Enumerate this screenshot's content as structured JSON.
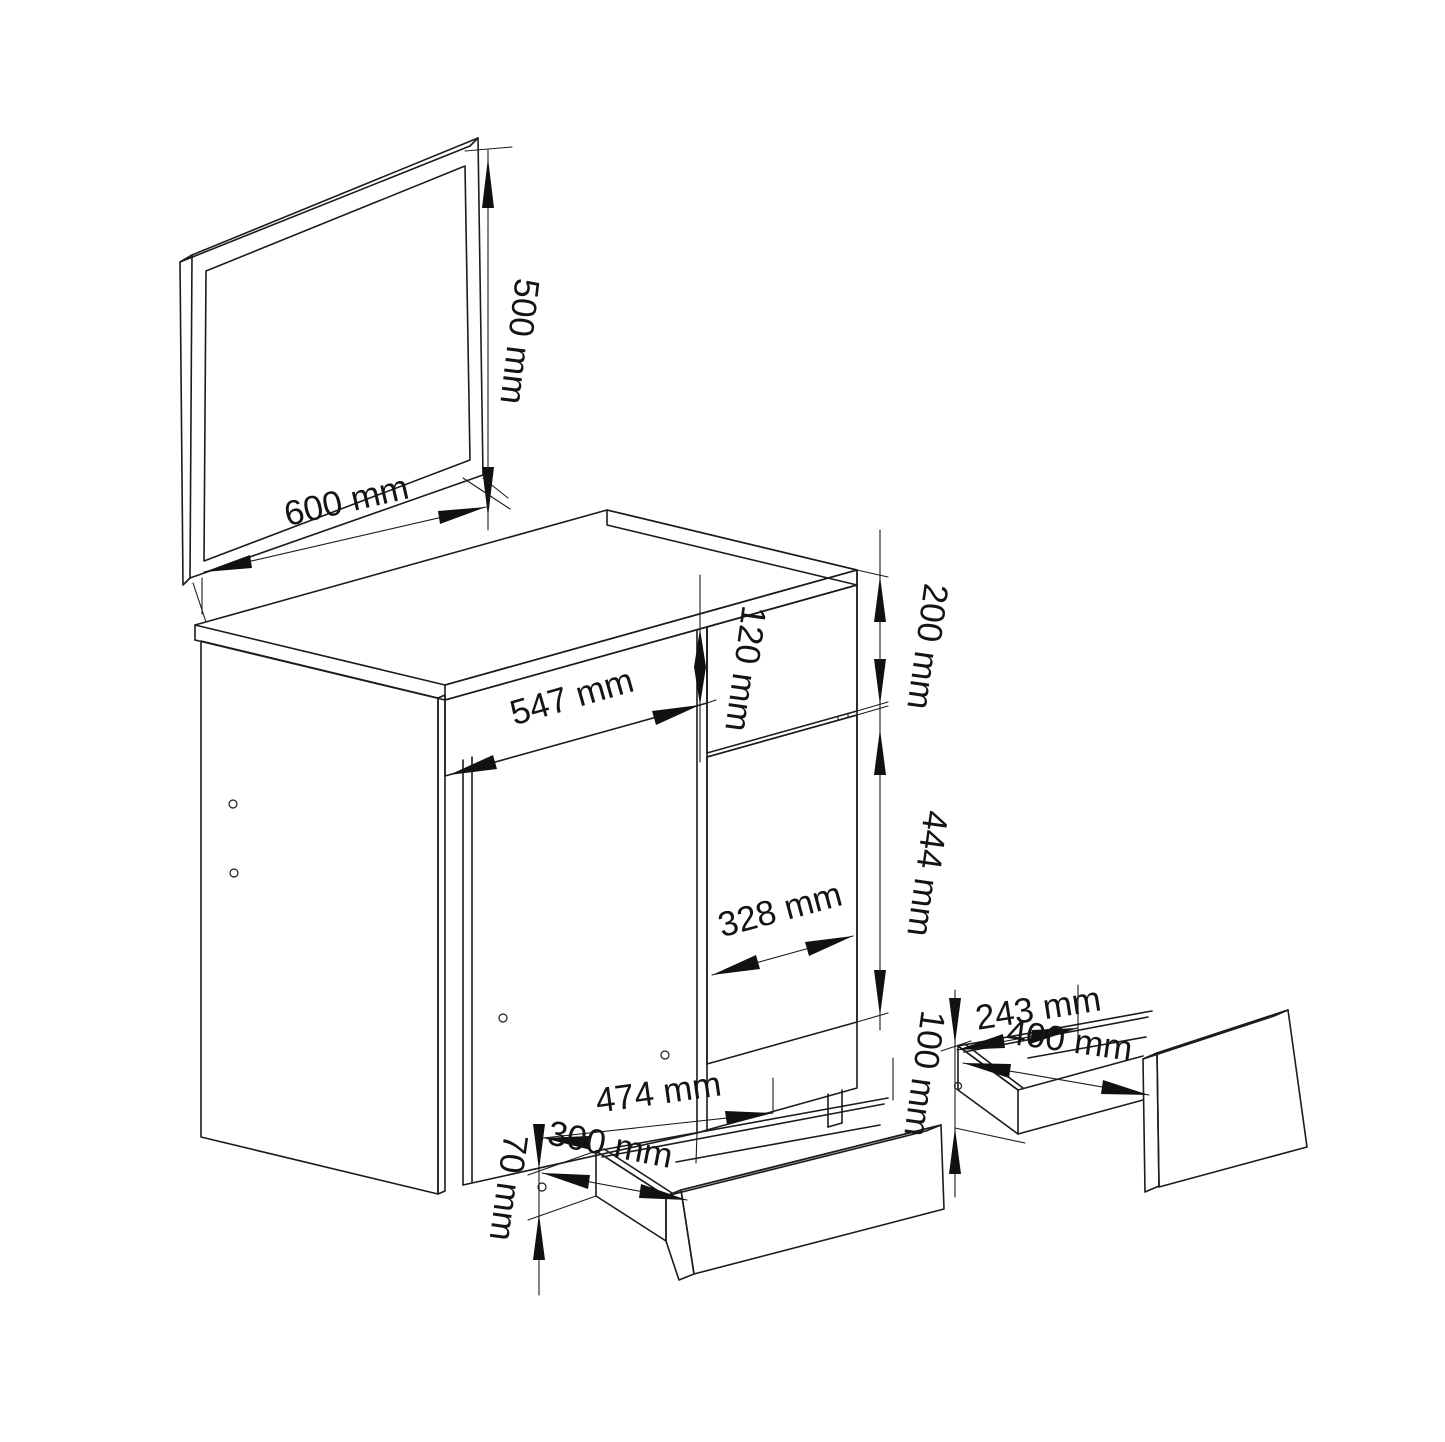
{
  "diagram": {
    "type": "furniture-assembly-dimension-drawing",
    "subject": "dressing table with mirror, pedestal cabinet and two pull-out drawers",
    "unit": "mm",
    "background_color": "#ffffff",
    "line_color": "#1c1c1c",
    "parts": {
      "mirror": {
        "width": "600 mm",
        "height": "500 mm"
      },
      "desk": {
        "apron_drawer_height": "120 mm",
        "pedestal_drawer_front_height": "200 mm",
        "knee_space_width": "547 mm",
        "door_height": "444 mm",
        "door_width": "328 mm"
      },
      "wide_drawer": {
        "box_width": "474 mm",
        "box_depth": "300 mm",
        "box_side_height": "70 mm"
      },
      "pedestal_drawer": {
        "front_height": "100 mm",
        "box_depth": "243 mm",
        "front_width": "400 mm"
      }
    },
    "labels": [
      {
        "id": "mirror-width",
        "text": "600 mm",
        "x": 349,
        "y": 512,
        "rot": -13
      },
      {
        "id": "mirror-height",
        "text": "500 mm",
        "x": 508,
        "y": 340,
        "rot": 97
      },
      {
        "id": "knee-space-width",
        "text": "547 mm",
        "x": 575,
        "y": 708,
        "rot": -16
      },
      {
        "id": "apron-height",
        "text": "120 mm",
        "x": 734,
        "y": 667,
        "rot": 98
      },
      {
        "id": "drawer-front-height",
        "text": "200 mm",
        "x": 916,
        "y": 645,
        "rot": 98
      },
      {
        "id": "door-height",
        "text": "444 mm",
        "x": 916,
        "y": 872,
        "rot": 98
      },
      {
        "id": "door-width",
        "text": "328 mm",
        "x": 783,
        "y": 921,
        "rot": -15
      },
      {
        "id": "wide-drawer-width",
        "text": "474 mm",
        "x": 660,
        "y": 1104,
        "rot": -8
      },
      {
        "id": "wide-drawer-depth",
        "text": "300 mm",
        "x": 608,
        "y": 1156,
        "rot": 11
      },
      {
        "id": "wide-drawer-side",
        "text": "70 mm",
        "x": 497,
        "y": 1186,
        "rot": 98
      },
      {
        "id": "pedestal-drawer-front",
        "text": "100 mm",
        "x": 913,
        "y": 1072,
        "rot": 98
      },
      {
        "id": "pedestal-drawer-depth",
        "text": "243 mm",
        "x": 1040,
        "y": 1020,
        "rot": -9
      },
      {
        "id": "pedestal-drawer-width",
        "text": "400 mm",
        "x": 1068,
        "y": 1052,
        "rot": 8
      }
    ]
  }
}
